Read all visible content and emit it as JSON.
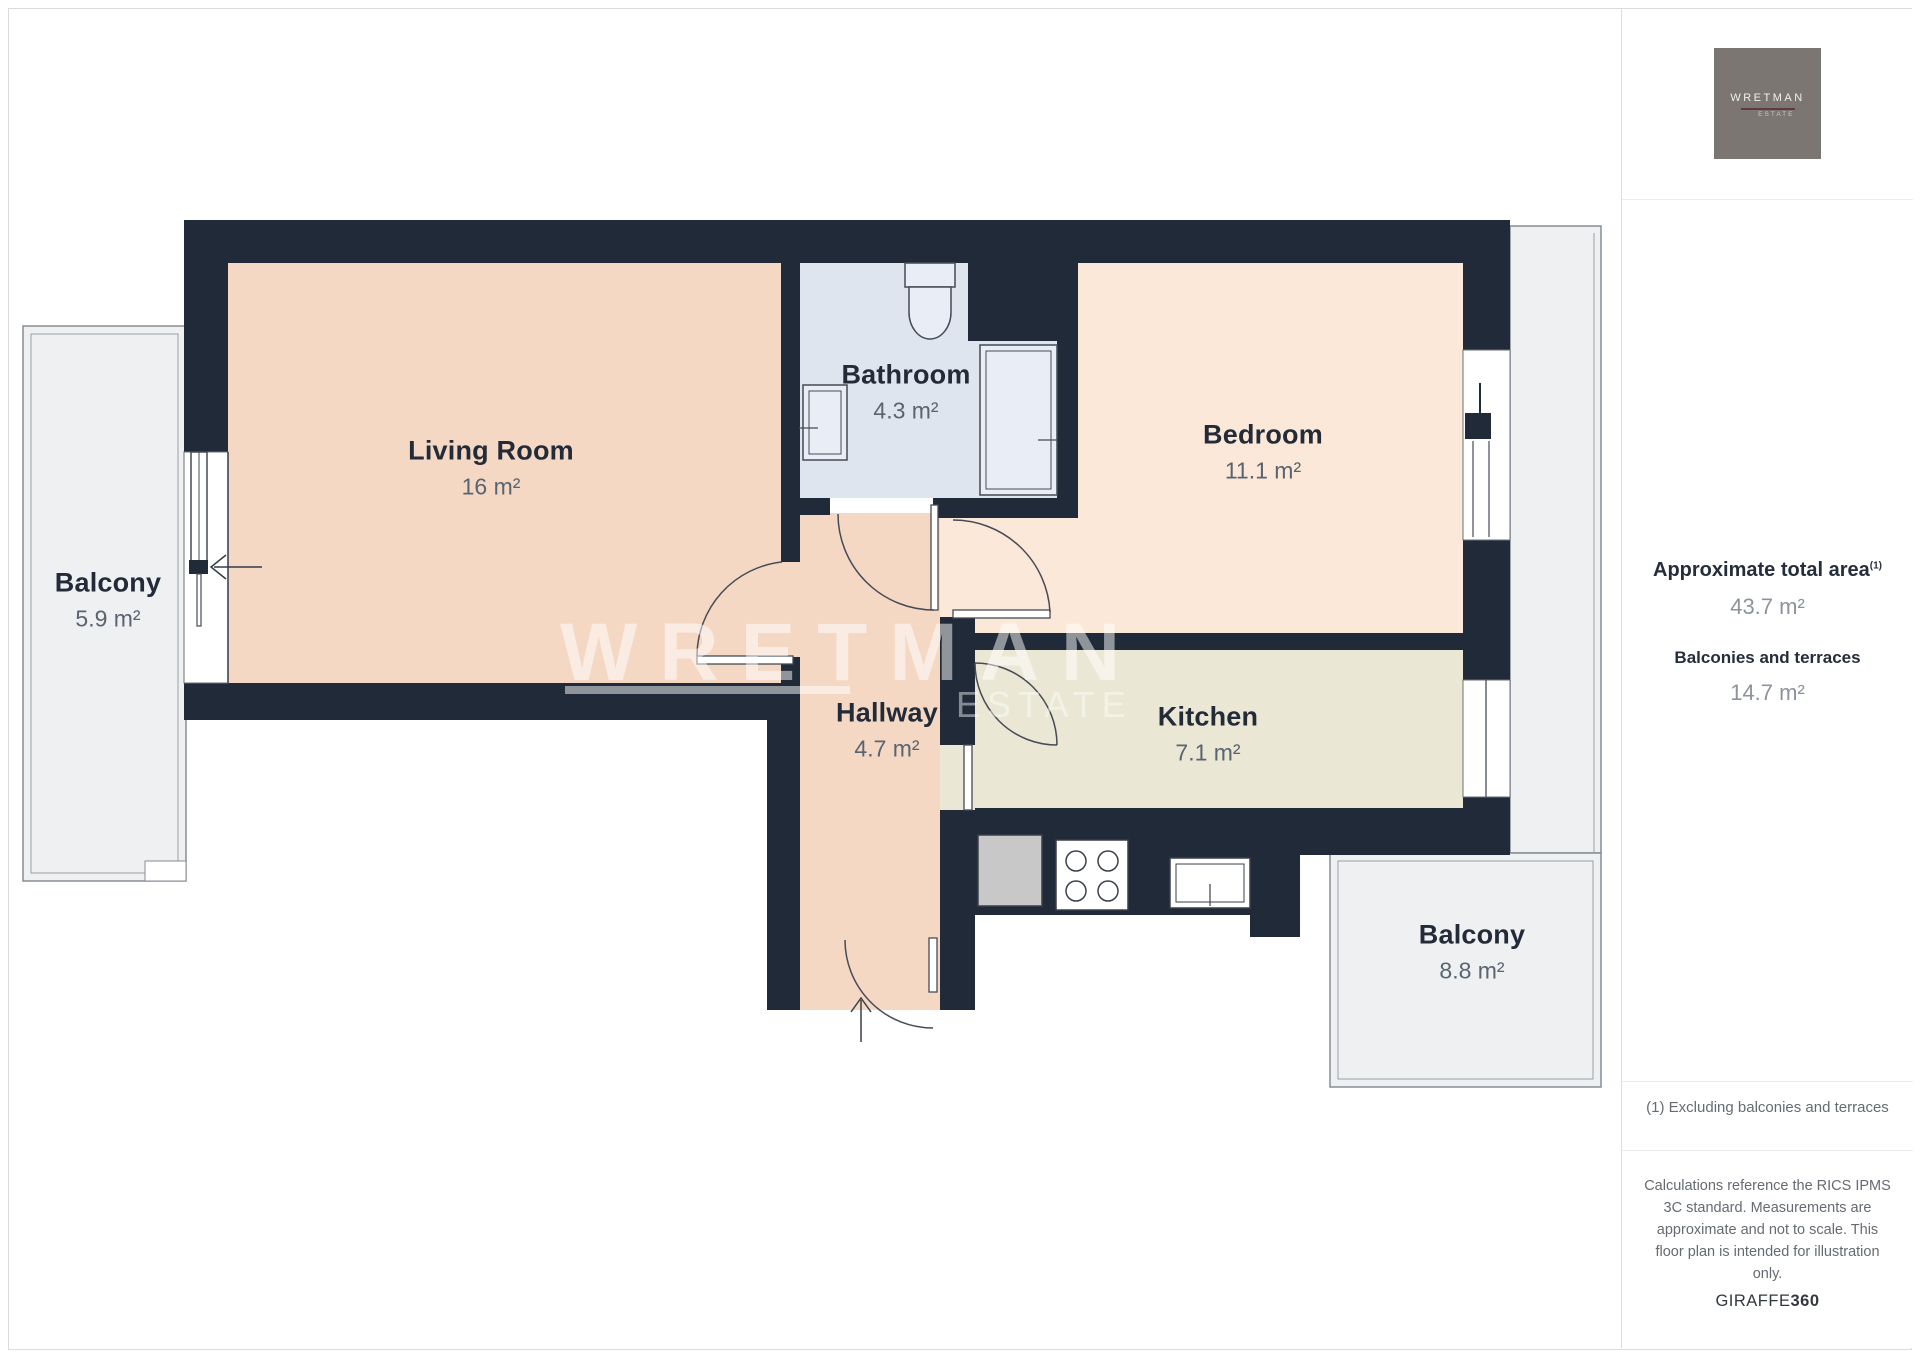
{
  "plan": {
    "rooms": [
      {
        "id": "living-room",
        "name": "Living Room",
        "area": "16 m²"
      },
      {
        "id": "bathroom",
        "name": "Bathroom",
        "area": "4.3 m²"
      },
      {
        "id": "bedroom",
        "name": "Bedroom",
        "area": "11.1 m²"
      },
      {
        "id": "hallway",
        "name": "Hallway",
        "area": "4.7 m²"
      },
      {
        "id": "kitchen",
        "name": "Kitchen",
        "area": "7.1 m²"
      },
      {
        "id": "balcony-left",
        "name": "Balcony",
        "area": "5.9 m²"
      },
      {
        "id": "balcony-right",
        "name": "Balcony",
        "area": "8.8 m²"
      }
    ],
    "watermark": {
      "word": "WRETMAN",
      "sub": "ESTATE"
    }
  },
  "sidebar": {
    "logo": {
      "name": "WRETMAN",
      "sub": "ESTATE"
    },
    "total_area": {
      "label": "Approximate total area",
      "sup": "(1)",
      "value": "43.7 m²"
    },
    "balconies": {
      "label": "Balconies and terraces",
      "value": "14.7 m²"
    },
    "footnote": "(1) Excluding balconies and terraces",
    "disclaimer": "Calculations reference the RICS IPMS 3C standard. Measurements are approximate and not to scale. This floor plan is intended for illustration only.",
    "brand": {
      "name": "GIRAFFE",
      "bold": "360"
    }
  },
  "colors": {
    "wall": "#202a38",
    "living_hall_fill": "#f4d8c4",
    "bedroom_fill": "#fbe8d8",
    "kitchen_fill": "#eae7d4",
    "bathroom_fill": "#dee5ef",
    "balcony_fill": "#eef0f2",
    "fixture_fill": "#e9eef6",
    "logo_bg": "#7b7671",
    "logo_rule": "#643742"
  }
}
